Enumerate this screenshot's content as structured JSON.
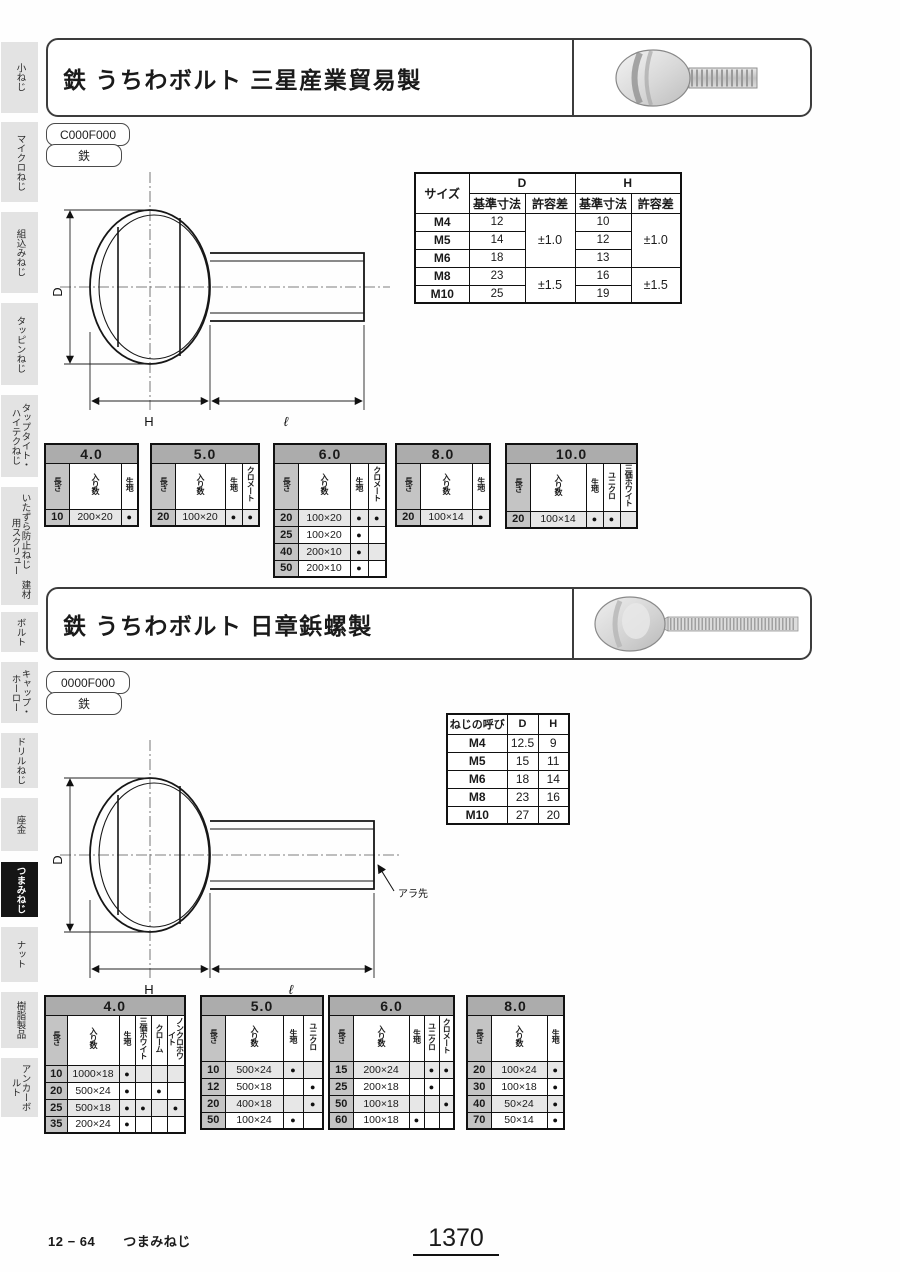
{
  "sidebar": {
    "items": [
      {
        "label": "小ねじ",
        "active": false
      },
      {
        "label": "マイクロねじ",
        "active": false
      },
      {
        "label": "組込みねじ",
        "active": false
      },
      {
        "label": "タッピンねじ",
        "active": false
      },
      {
        "label": "タップタイト・ ハイテクねじ",
        "active": false
      },
      {
        "label": "いたずら防止ねじ 建材用スクリュー",
        "active": false
      },
      {
        "label": "ボルト",
        "active": false
      },
      {
        "label": "キャップ・ホーロー",
        "active": false
      },
      {
        "label": "ドリルねじ",
        "active": false
      },
      {
        "label": "座金",
        "active": false
      },
      {
        "label": "つまみねじ",
        "active": true
      },
      {
        "label": "ナット",
        "active": false
      },
      {
        "label": "樹脂製品",
        "active": false
      },
      {
        "label": "アンカーボルト",
        "active": false
      }
    ]
  },
  "sections": [
    {
      "title": "鉄 うちわボルト 三星産業貿易製",
      "code": "C000F000",
      "material": "鉄",
      "drawing": {
        "d_label": "D",
        "h_label": "H",
        "length_label": "ℓ"
      },
      "dim_table": {
        "corner": "サイズ",
        "col_d": "D",
        "col_h": "H",
        "sub_base": "基準寸法",
        "sub_tol": "許容差",
        "d_tol_upper": "±1.0",
        "d_tol_lower": "±1.5",
        "h_tol_upper": "±1.0",
        "h_tol_lower": "±1.5",
        "rows": [
          {
            "size": "M4",
            "d": "12",
            "h": "10"
          },
          {
            "size": "M5",
            "d": "14",
            "h": "12"
          },
          {
            "size": "M6",
            "d": "18",
            "h": "13"
          },
          {
            "size": "M8",
            "d": "23",
            "h": "16"
          },
          {
            "size": "M10",
            "d": "25",
            "h": "19"
          }
        ]
      },
      "size_tables": [
        {
          "title": "4.0",
          "columns": [
            "長さ",
            "入り数",
            "生地"
          ],
          "rows": [
            [
              "10",
              "200×20",
              "●"
            ]
          ]
        },
        {
          "title": "5.0",
          "columns": [
            "長さ",
            "入り数",
            "生地",
            "クロメート"
          ],
          "rows": [
            [
              "20",
              "100×20",
              "●",
              "●"
            ]
          ]
        },
        {
          "title": "6.0",
          "columns": [
            "長さ",
            "入り数",
            "生地",
            "クロメート"
          ],
          "rows": [
            [
              "20",
              "100×20",
              "●",
              "●"
            ],
            [
              "25",
              "100×20",
              "●",
              ""
            ],
            [
              "40",
              "200×10",
              "●",
              ""
            ],
            [
              "50",
              "200×10",
              "●",
              ""
            ]
          ]
        },
        {
          "title": "8.0",
          "columns": [
            "長さ",
            "入り数",
            "生地"
          ],
          "rows": [
            [
              "20",
              "100×14",
              "●"
            ]
          ]
        },
        {
          "title": "10.0",
          "columns": [
            "長さ",
            "入り数",
            "生地",
            "ユニクロ",
            "三価ホワイト"
          ],
          "rows": [
            [
              "20",
              "100×14",
              "●",
              "●",
              ""
            ]
          ]
        }
      ]
    },
    {
      "title": "鉄 うちわボルト 日章鋲螺製",
      "code": "0000F000",
      "material": "鉄",
      "drawing": {
        "d_label": "D",
        "h_label": "H",
        "length_label": "ℓ",
        "tip_label": "アラ先"
      },
      "dim_table": {
        "headers": [
          "ねじの呼び",
          "D",
          "H"
        ],
        "rows": [
          [
            "M4",
            "12.5",
            "9"
          ],
          [
            "M5",
            "15",
            "11"
          ],
          [
            "M6",
            "18",
            "14"
          ],
          [
            "M8",
            "23",
            "16"
          ],
          [
            "M10",
            "27",
            "20"
          ]
        ]
      },
      "size_tables": [
        {
          "title": "4.0",
          "columns": [
            "長さ",
            "入り数",
            "生地",
            "三価ホワイト",
            "クローム",
            "ノンクロホワイト"
          ],
          "rows": [
            [
              "10",
              "1000×18",
              "●",
              "",
              "",
              ""
            ],
            [
              "20",
              "500×24",
              "●",
              "",
              "●",
              ""
            ],
            [
              "25",
              "500×18",
              "●",
              "●",
              "",
              "●"
            ],
            [
              "35",
              "200×24",
              "●",
              "",
              "",
              ""
            ]
          ]
        },
        {
          "title": "5.0",
          "columns": [
            "長さ",
            "入り数",
            "生地",
            "ユニクロ"
          ],
          "rows": [
            [
              "10",
              "500×24",
              "●",
              ""
            ],
            [
              "12",
              "500×18",
              "",
              "●"
            ],
            [
              "20",
              "400×18",
              "",
              "●"
            ],
            [
              "50",
              "100×24",
              "●",
              ""
            ]
          ]
        },
        {
          "title": "6.0",
          "columns": [
            "長さ",
            "入り数",
            "生地",
            "ユニクロ",
            "クロメート"
          ],
          "rows": [
            [
              "15",
              "200×24",
              "",
              "●",
              "●"
            ],
            [
              "25",
              "200×18",
              "",
              "●",
              ""
            ],
            [
              "50",
              "100×18",
              "",
              "",
              "●"
            ],
            [
              "60",
              "100×18",
              "●",
              "",
              ""
            ]
          ]
        },
        {
          "title": "8.0",
          "columns": [
            "長さ",
            "入り数",
            "生地"
          ],
          "rows": [
            [
              "20",
              "100×24",
              "●"
            ],
            [
              "30",
              "100×18",
              "●"
            ],
            [
              "40",
              "50×24",
              "●"
            ],
            [
              "70",
              "50×14",
              "●"
            ]
          ]
        }
      ]
    }
  ],
  "footer": {
    "code": "12 − 64",
    "label": "つまみねじ",
    "page": "1370"
  }
}
